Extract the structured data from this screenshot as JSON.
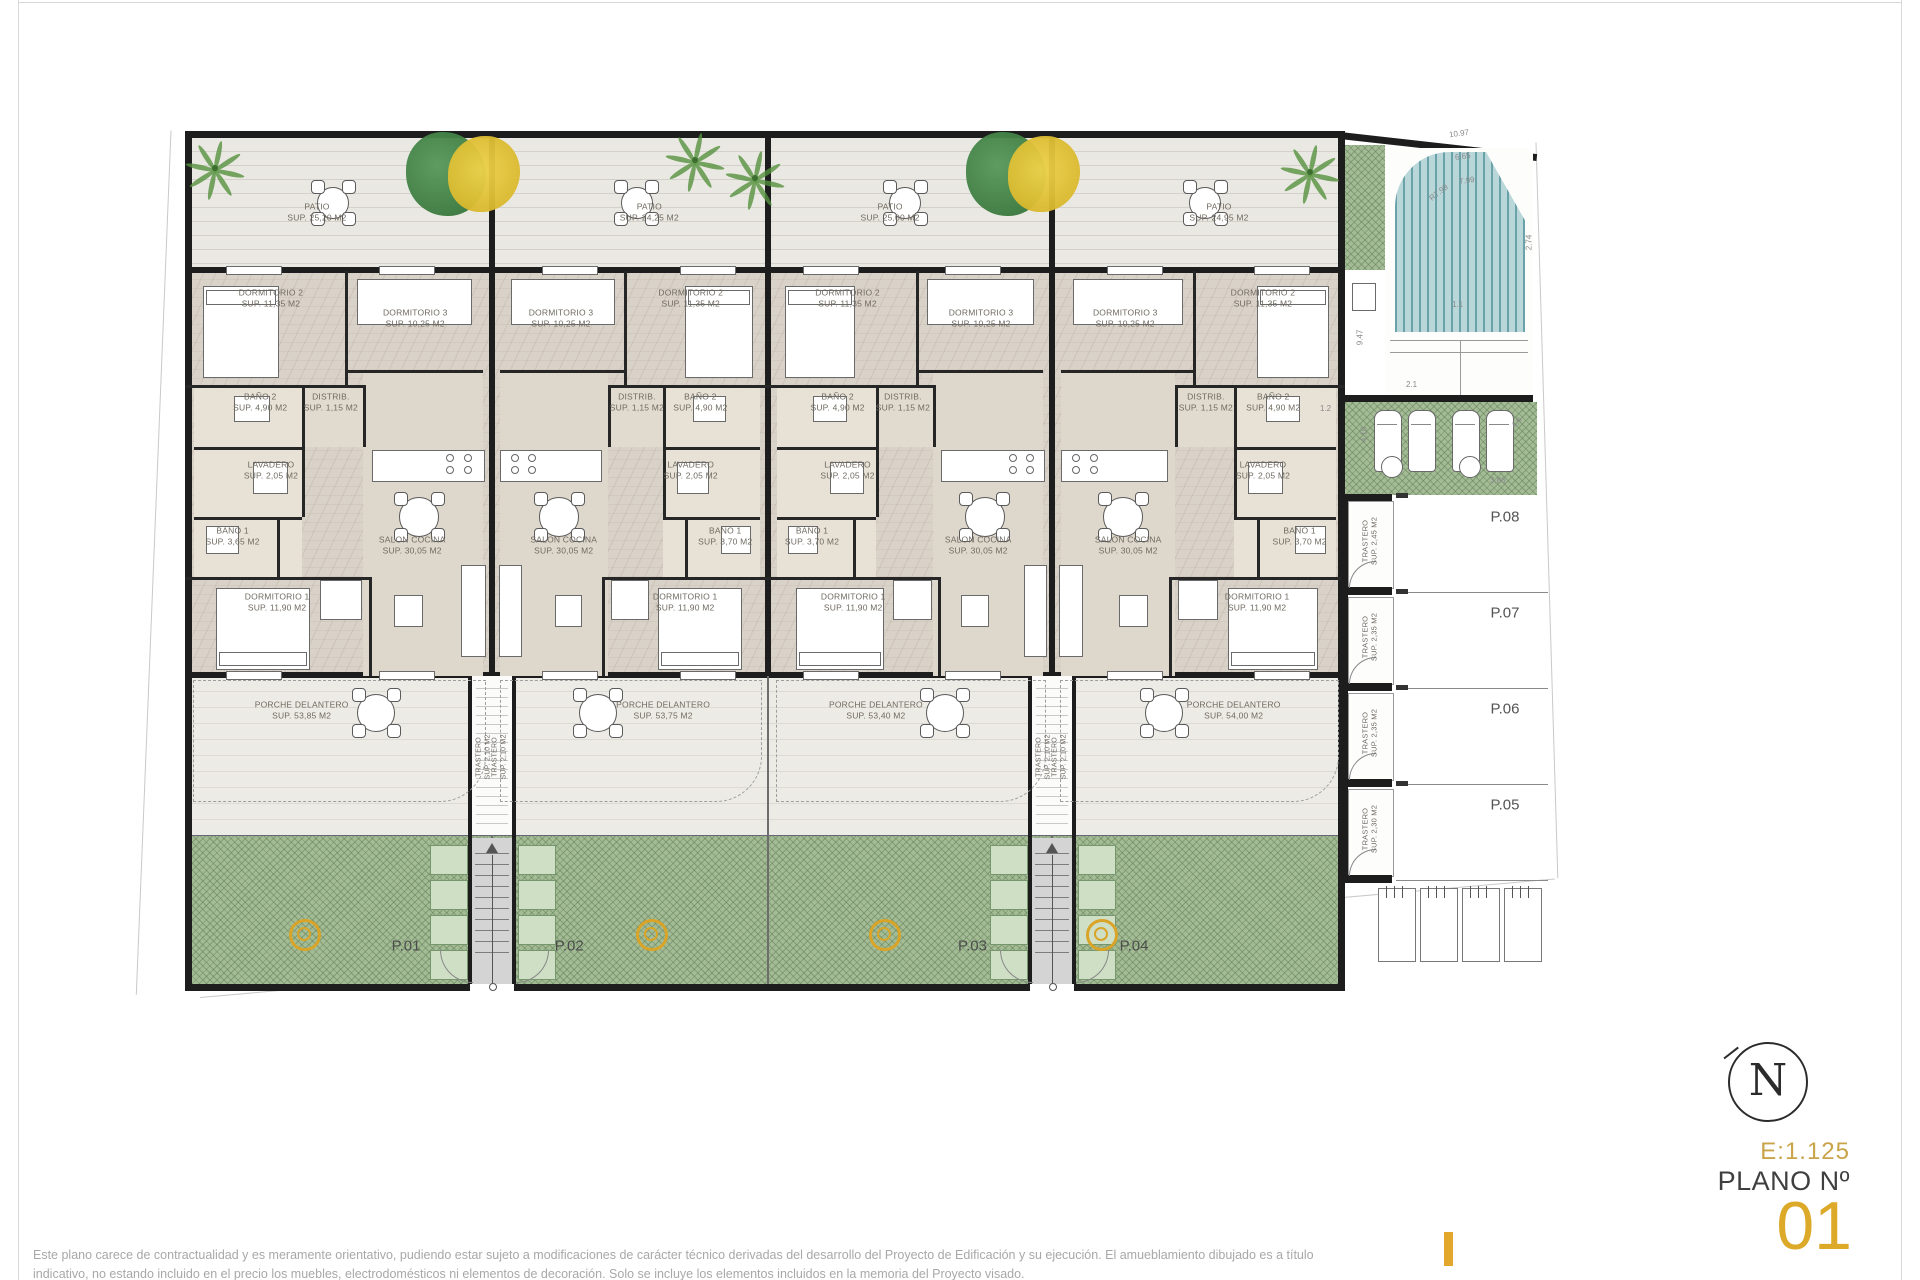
{
  "page": {
    "disclaimer": {
      "line1": "Este plano carece de contractualidad y es meramente orientativo, pudiendo estar sujeto a modificaciones de carácter técnico derivadas del desarrollo del Proyecto de Edificación y su ejecución. El amueblamiento dibujado es a título",
      "line2": "indicativo, no estando incluido en el precio los muebles, electrodomésticos ni elementos de decoración. Solo se incluye los elementos incluidos en la memoria del Proyecto visado."
    },
    "title_block": {
      "scale": "E:1.125",
      "plano_label": "PLANO Nº",
      "plano_number": "01",
      "north_letter": "N"
    }
  },
  "colors": {
    "wall": "#1d1d1d",
    "accent_gold": "#d7a62c",
    "patio_bg": "#eae8e2",
    "interior_bg": "#d9d2c8",
    "porch_bg": "#edebe5",
    "garden_green": "#a3bc96",
    "planter_green": "#cfdfc6",
    "pool_teal": "#69a2a8"
  },
  "plan": {
    "units": [
      {
        "id": "P.01",
        "patio": {
          "name": "PATIO",
          "sup": "SUP. 25,20 M2"
        },
        "porch": {
          "name": "PORCHE DELANTERO",
          "sup": "SUP. 53,85 M2"
        },
        "rooms": [
          {
            "name": "DORMITORIO 2",
            "sup": "SUP. 11,35 M2"
          },
          {
            "name": "DORMITORIO 3",
            "sup": "SUP. 10,25 M2"
          },
          {
            "name": "BAÑO 2",
            "sup": "SUP. 4,90 M2"
          },
          {
            "name": "DISTRIB.",
            "sup": "SUP. 1,15 M2"
          },
          {
            "name": "LAVADERO",
            "sup": "SUP. 2,05 M2"
          },
          {
            "name": "BAÑO 1",
            "sup": "SUP. 3,65 M2"
          },
          {
            "name": "DORMITORIO 1",
            "sup": "SUP. 11,90 M2"
          },
          {
            "name": "SALON COCINA",
            "sup": "SUP. 30,05 M2"
          }
        ]
      },
      {
        "id": "P.02",
        "patio": {
          "name": "PATIO",
          "sup": "SUP. 24,25 M2"
        },
        "porch": {
          "name": "PORCHE DELANTERO",
          "sup": "SUP. 53,75 M2"
        },
        "rooms": [
          {
            "name": "DORMITORIO 2",
            "sup": "SUP. 11,35 M2"
          },
          {
            "name": "DORMITORIO 3",
            "sup": "SUP. 10,25 M2"
          },
          {
            "name": "BAÑO 2",
            "sup": "SUP. 4,90 M2"
          },
          {
            "name": "DISTRIB.",
            "sup": "SUP. 1,15 M2"
          },
          {
            "name": "LAVADERO",
            "sup": "SUP. 2,05 M2"
          },
          {
            "name": "BAÑO 1",
            "sup": "SUP. 3,70 M2"
          },
          {
            "name": "DORMITORIO 1",
            "sup": "SUP. 11,90 M2"
          },
          {
            "name": "SALON COCINA",
            "sup": "SUP. 30,05 M2"
          }
        ]
      },
      {
        "id": "P.03",
        "patio": {
          "name": "PATIO",
          "sup": "SUP. 25,00 M2"
        },
        "porch": {
          "name": "PORCHE DELANTERO",
          "sup": "SUP. 53,40 M2"
        },
        "rooms": [
          {
            "name": "DORMITORIO 2",
            "sup": "SUP. 11,35 M2"
          },
          {
            "name": "DORMITORIO 3",
            "sup": "SUP. 10,25 M2"
          },
          {
            "name": "BAÑO 2",
            "sup": "SUP. 4,90 M2"
          },
          {
            "name": "DISTRIB.",
            "sup": "SUP. 1,15 M2"
          },
          {
            "name": "LAVADERO",
            "sup": "SUP. 2,05 M2"
          },
          {
            "name": "BAÑO 1",
            "sup": "SUP. 3,70 M2"
          },
          {
            "name": "DORMITORIO 1",
            "sup": "SUP. 11,90 M2"
          },
          {
            "name": "SALON COCINA",
            "sup": "SUP. 30,05 M2"
          }
        ]
      },
      {
        "id": "P.04",
        "patio": {
          "name": "PATIO",
          "sup": "SUP. 24,95 M2"
        },
        "porch": {
          "name": "PORCHE DELANTERO",
          "sup": "SUP. 54,00 M2"
        },
        "rooms": [
          {
            "name": "DORMITORIO 2",
            "sup": "SUP. 11,35 M2"
          },
          {
            "name": "DORMITORIO 3",
            "sup": "SUP. 10,25 M2"
          },
          {
            "name": "BAÑO 2",
            "sup": "SUP. 4,90 M2"
          },
          {
            "name": "DISTRIB.",
            "sup": "SUP. 1,15 M2"
          },
          {
            "name": "LAVADERO",
            "sup": "SUP. 2,05 M2"
          },
          {
            "name": "BAÑO 1",
            "sup": "SUP. 3,70 M2"
          },
          {
            "name": "DORMITORIO 1",
            "sup": "SUP. 11,90 M2"
          },
          {
            "name": "SALON COCINA",
            "sup": "SUP. 30,05 M2"
          }
        ]
      }
    ],
    "stair_label": {
      "name": "TRASTERO",
      "sup": "SUP. 2,10 M2"
    },
    "right_zone": {
      "trasteros": [
        {
          "name": "TRASTERO",
          "sup": "SUP. 2,45 M2"
        },
        {
          "name": "TRASTERO",
          "sup": "SUP. 2,35 M2"
        },
        {
          "name": "TRASTERO",
          "sup": "SUP. 2,35 M2"
        },
        {
          "name": "TRASTERO",
          "sup": "SUP. 2,30 M2"
        }
      ],
      "parking_labels": [
        "P.08",
        "P.07",
        "P.06",
        "P.05"
      ],
      "dimensions": [
        "10.97",
        "6.65",
        "7.99",
        "R7.99",
        "2.74",
        "1.1",
        "9.47",
        "2.1",
        "1.2",
        "4,16",
        "4,6",
        "3,86"
      ]
    }
  }
}
